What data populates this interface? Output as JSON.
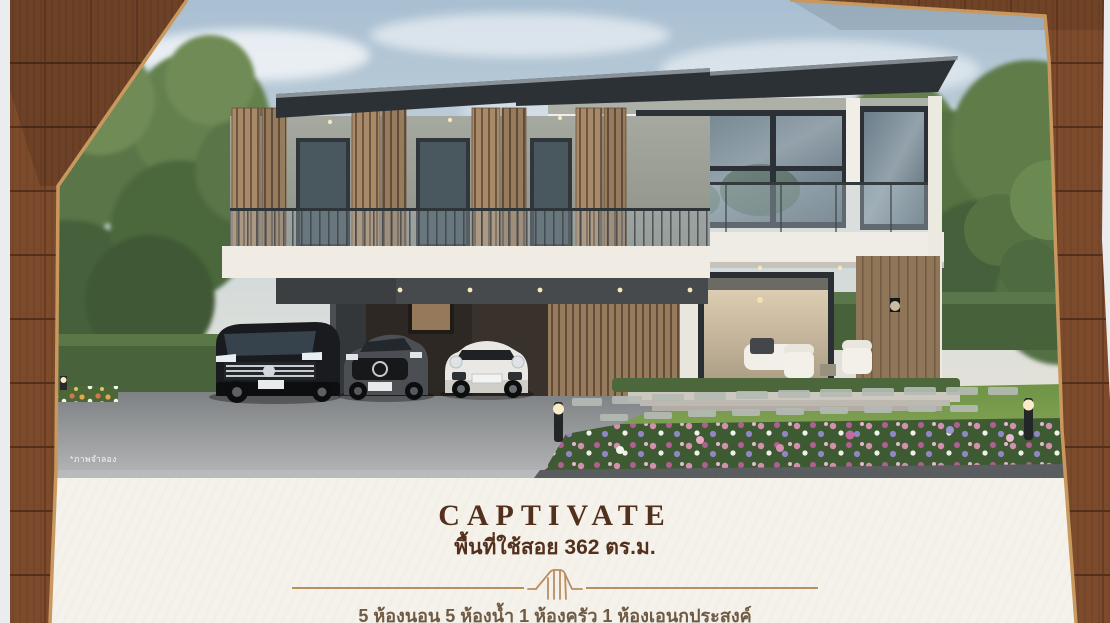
{
  "hero": {
    "disclaimer": "*ภาพจำลอง",
    "scene_elements": [
      "modern-two-storey-house",
      "wood-louver-shutters",
      "glass-balcony",
      "carport",
      "black-van",
      "grey-sedan",
      "white-sports-car",
      "timber-slat-screen",
      "lawn-stepping-stones",
      "flower-bed",
      "bollard-lights",
      "hedge",
      "trees",
      "driveway"
    ]
  },
  "info": {
    "title": "CAPTIVATE",
    "area_label": "พื้นที่ใช้สอย 362 ตร.ม.",
    "specs_label": "5 ห้องนอน 5 ห้องน้ำ 1 ห้องครัว 1 ห้องเอนกประสงค์",
    "divider_icon": "house-gable-icon"
  },
  "colors": {
    "accent_brown": "#53301c",
    "divider_tan": "#b98e60",
    "cream_bg": "#f5f2ec",
    "specs_brown": "#6f5a44",
    "frame_wood": "#7a4a2b",
    "frame_edge_tan": "#c9985e",
    "sky_blue": "#a9bfd2",
    "roof_dark": "#2c3136"
  }
}
